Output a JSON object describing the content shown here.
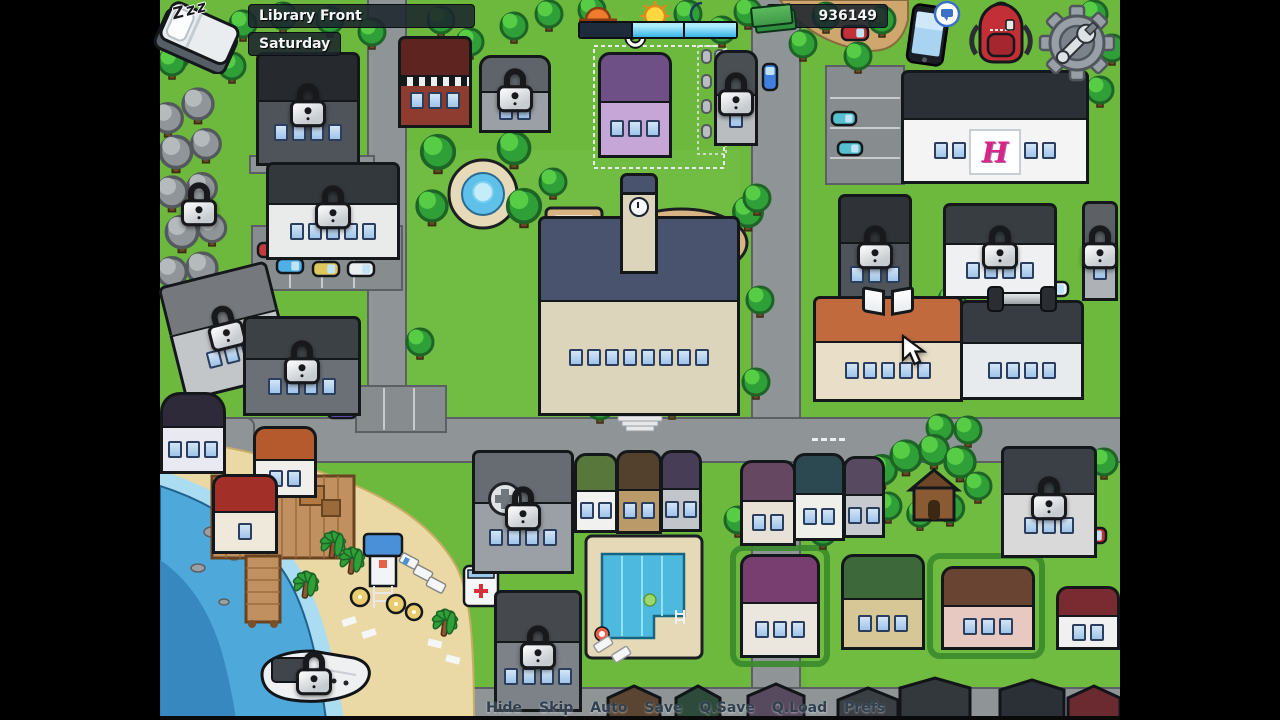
{
  "hud": {
    "sleep_label": "Zzz",
    "location_label": "Library Front",
    "day_label": "Saturday",
    "money": "936149",
    "time_periods": [
      {
        "id": "morning",
        "state": "elapsed"
      },
      {
        "id": "afternoon",
        "state": "remaining"
      },
      {
        "id": "evening",
        "state": "remaining"
      }
    ],
    "icons": [
      "bed-icon",
      "sunrise-icon",
      "sun-icon",
      "moon-icon",
      "cash-icon",
      "phone-icon",
      "backpack-icon",
      "settings-gear-icon"
    ]
  },
  "quick_menu": {
    "items": [
      "Hide",
      "Skip",
      "Auto",
      "Save",
      "Q.Save",
      "Q.Load",
      "Prefs"
    ]
  },
  "map": {
    "hospital_sign": "H",
    "palette": {
      "grass": "#6db93e",
      "road": "#8f9496",
      "sand": "#ead9a4",
      "water": "#4fa8da",
      "outline": "#14181c",
      "lock_body": "#dfe4e8",
      "time_elapsed": "#1d2b3a",
      "time_remaining": "#45bdee"
    },
    "locations": [
      {
        "id": "locked-forest",
        "x": 160,
        "y": 96,
        "w": 78,
        "h": 224,
        "style": "hotspot",
        "locked": true
      },
      {
        "id": "warehouse",
        "x": 256,
        "y": 52,
        "w": 104,
        "h": 114,
        "style": "building",
        "roof": "#26292d",
        "body": "#4e545a",
        "windows": 4,
        "locked": true
      },
      {
        "id": "car-dealership",
        "x": 266,
        "y": 162,
        "w": 134,
        "h": 98,
        "style": "building",
        "roof": "#33383d",
        "body": "#e9eaea",
        "windows": 5,
        "locked": true
      },
      {
        "id": "diner",
        "x": 398,
        "y": 36,
        "w": 74,
        "h": 92,
        "style": "building",
        "cls": "diner",
        "roof": "#5d2420",
        "body": "#8e3b30",
        "windows": 3
      },
      {
        "id": "gray-house",
        "x": 479,
        "y": 55,
        "w": 72,
        "h": 78,
        "style": "house",
        "roof": "#5f646a",
        "body": "#9aa0a5",
        "windows": 2,
        "locked": true
      },
      {
        "id": "mansion",
        "x": 598,
        "y": 52,
        "w": 74,
        "h": 106,
        "style": "house",
        "roof": "#6e4f86",
        "body": "#c5a6d6",
        "windows": 3,
        "icon": "refresh"
      },
      {
        "id": "church",
        "x": 714,
        "y": 50,
        "w": 44,
        "h": 96,
        "style": "house",
        "roof": "#4a4f54",
        "body": "#b9bdc0",
        "windows": 1,
        "locked": true
      },
      {
        "id": "park-fountain",
        "x": 426,
        "y": 140,
        "w": 114,
        "h": 92,
        "style": "hotspot"
      },
      {
        "id": "trailer",
        "x": 170,
        "y": 272,
        "w": 112,
        "h": 118,
        "style": "building",
        "roof": "#75797d",
        "body": "#c2c6c9",
        "windows": 3,
        "locked": true,
        "rot": -14
      },
      {
        "id": "workshop",
        "x": 243,
        "y": 316,
        "w": 118,
        "h": 100,
        "style": "building",
        "roof": "#3c4146",
        "body": "#6a7076",
        "windows": 4,
        "locked": true
      },
      {
        "id": "basketball-court",
        "x": 546,
        "y": 208,
        "w": 56,
        "h": 66,
        "style": "hotspot"
      },
      {
        "id": "sports-field",
        "x": 614,
        "y": 210,
        "w": 134,
        "h": 68,
        "style": "hotspot"
      },
      {
        "id": "school",
        "x": 538,
        "y": 216,
        "w": 202,
        "h": 200,
        "style": "building",
        "roof": "#49536e",
        "body": "#ddd4bc",
        "windows": 8,
        "tower": true
      },
      {
        "id": "hospital",
        "x": 901,
        "y": 70,
        "w": 188,
        "h": 114,
        "style": "building",
        "roof": "#2b3036",
        "body": "#f4f4f4",
        "windows": 7,
        "icon": "hsign"
      },
      {
        "id": "apartment-north",
        "x": 838,
        "y": 194,
        "w": 74,
        "h": 114,
        "style": "building",
        "roof": "#2f3337",
        "body": "#4e545a",
        "windows": 3,
        "locked": true
      },
      {
        "id": "police-station",
        "x": 943,
        "y": 203,
        "w": 114,
        "h": 96,
        "style": "building",
        "roof": "#383d42",
        "body": "#eef0f1",
        "windows": 4,
        "locked": true
      },
      {
        "id": "bell-tower",
        "x": 1082,
        "y": 201,
        "w": 36,
        "h": 100,
        "style": "building",
        "roof": "#5d6165",
        "body": "#aeb2b6",
        "windows": 1,
        "locked": true
      },
      {
        "id": "library",
        "x": 813,
        "y": 296,
        "w": 150,
        "h": 106,
        "style": "building",
        "roof": "#c06a3e",
        "body": "#e9dfc8",
        "windows": 5,
        "icon": "book"
      },
      {
        "id": "gym",
        "x": 960,
        "y": 300,
        "w": 124,
        "h": 100,
        "style": "building",
        "roof": "#363c41",
        "body": "#e7ebee",
        "windows": 4,
        "icon": "dumbbell"
      },
      {
        "id": "round-building",
        "x": 160,
        "y": 392,
        "w": 66,
        "h": 82,
        "style": "building",
        "cls": "round",
        "roof": "#2e2a3a",
        "body": "#e9e9f2",
        "windows": 3
      },
      {
        "id": "orange-house",
        "x": 253,
        "y": 426,
        "w": 64,
        "h": 72,
        "style": "house",
        "roof": "#b55a2c",
        "body": "#f0efec",
        "windows": 2
      },
      {
        "id": "beach",
        "x": 260,
        "y": 520,
        "w": 190,
        "h": 130,
        "style": "hotspot"
      },
      {
        "id": "boathouse",
        "x": 212,
        "y": 474,
        "w": 66,
        "h": 80,
        "style": "house",
        "roof": "#a33028",
        "body": "#efe9dc",
        "windows": 1
      },
      {
        "id": "clinic",
        "x": 472,
        "y": 450,
        "w": 102,
        "h": 124,
        "style": "building",
        "roof": "#666c71",
        "body": "#9aa0a5",
        "windows": 4,
        "locked": true,
        "icon": "cross"
      },
      {
        "id": "house-1",
        "x": 574,
        "y": 453,
        "w": 44,
        "h": 80,
        "style": "house",
        "roof": "#57783a",
        "body": "#f1f1ef",
        "windows": 2
      },
      {
        "id": "house-2",
        "x": 616,
        "y": 450,
        "w": 46,
        "h": 84,
        "style": "house",
        "roof": "#53412e",
        "body": "#bb9a6a",
        "windows": 2
      },
      {
        "id": "house-3",
        "x": 660,
        "y": 450,
        "w": 42,
        "h": 82,
        "style": "house",
        "roof": "#473d56",
        "body": "#c2c6ca",
        "windows": 2
      },
      {
        "id": "house-4",
        "x": 740,
        "y": 460,
        "w": 56,
        "h": 86,
        "style": "house",
        "roof": "#664761",
        "body": "#e7e1d6",
        "windows": 2
      },
      {
        "id": "house-5",
        "x": 793,
        "y": 453,
        "w": 52,
        "h": 88,
        "style": "house",
        "roof": "#2c4850",
        "body": "#f0f0ea",
        "windows": 2
      },
      {
        "id": "house-6",
        "x": 843,
        "y": 456,
        "w": 42,
        "h": 82,
        "style": "house",
        "roof": "#574a60",
        "body": "#c7cbcf",
        "windows": 2
      },
      {
        "id": "treehouse",
        "x": 894,
        "y": 460,
        "w": 72,
        "h": 82,
        "style": "hotspot"
      },
      {
        "id": "mansion-se",
        "x": 1001,
        "y": 446,
        "w": 96,
        "h": 112,
        "style": "building",
        "roof": "#3a4045",
        "body": "#d9d9d9",
        "windows": 3,
        "locked": true
      },
      {
        "id": "pool",
        "x": 586,
        "y": 536,
        "w": 116,
        "h": 122,
        "style": "hotspot"
      },
      {
        "id": "apartment-south",
        "x": 494,
        "y": 590,
        "w": 88,
        "h": 122,
        "style": "building",
        "roof": "#45494e",
        "body": "#7d8288",
        "windows": 4,
        "locked": true
      },
      {
        "id": "house-7",
        "x": 740,
        "y": 554,
        "w": 80,
        "h": 104,
        "style": "house",
        "roof": "#773e6f",
        "body": "#ebe7df",
        "windows": 3
      },
      {
        "id": "house-8",
        "x": 841,
        "y": 554,
        "w": 84,
        "h": 96,
        "style": "house",
        "roof": "#3d6839",
        "body": "#d7c796",
        "windows": 3
      },
      {
        "id": "house-9",
        "x": 941,
        "y": 566,
        "w": 94,
        "h": 84,
        "style": "house",
        "roof": "#6a4433",
        "body": "#e8c9c1",
        "windows": 3
      },
      {
        "id": "house-10",
        "x": 1056,
        "y": 586,
        "w": 64,
        "h": 64,
        "style": "house",
        "roof": "#7a2a31",
        "body": "#f0f0f0",
        "windows": 2
      },
      {
        "id": "boat",
        "x": 256,
        "y": 646,
        "w": 116,
        "h": 62,
        "style": "hotspot",
        "locked": true
      }
    ]
  },
  "cursor": {
    "x": 901,
    "y": 334
  }
}
